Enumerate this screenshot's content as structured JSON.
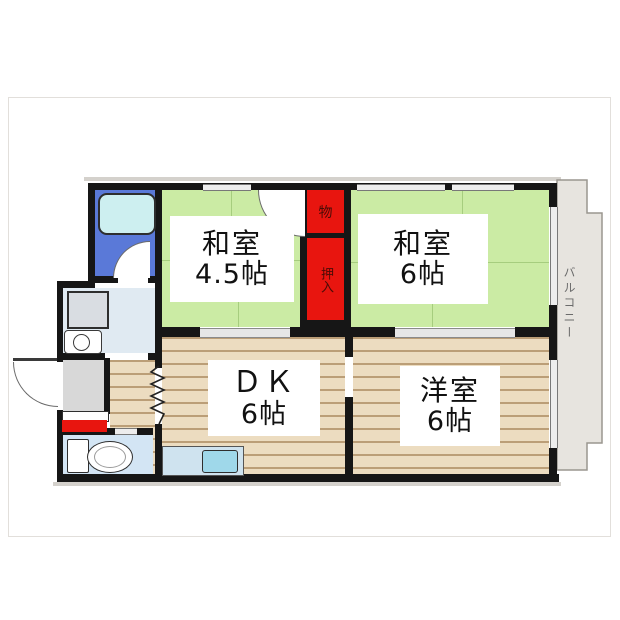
{
  "title": "apartment-floorplan",
  "rooms": {
    "washitsu45": {
      "line1": "和室",
      "line2": "4.5帖"
    },
    "washitsu6": {
      "line1": "和室",
      "line2": "6帖"
    },
    "dk": {
      "line1": "ＤＫ",
      "line2": "6帖"
    },
    "youshitsu": {
      "line1": "洋室",
      "line2": "6帖"
    }
  },
  "closets": {
    "storage": "物",
    "oshiire": "押入"
  },
  "balcony": {
    "label": "バルコニー"
  },
  "fixtures": [
    "bathtub",
    "washing-machine",
    "washbasin",
    "toilet",
    "kitchen-sink",
    "shoe-cabinet"
  ],
  "colors": {
    "tatami_green": "#cbeba4",
    "closet_red": "#e8150f",
    "wood_floor": "#ecdcc0",
    "wood_stripe": "#bb9e77",
    "bathroom_blue": "#5a79d8",
    "bathtub_cyan": "#cdeff0",
    "toilet_floor": "#d3e5f4",
    "washroom_floor": "#e0eaf2",
    "entrance_gray": "#d8d8d8",
    "balcony_gray": "#e7e4df",
    "wall_black": "#161616"
  }
}
